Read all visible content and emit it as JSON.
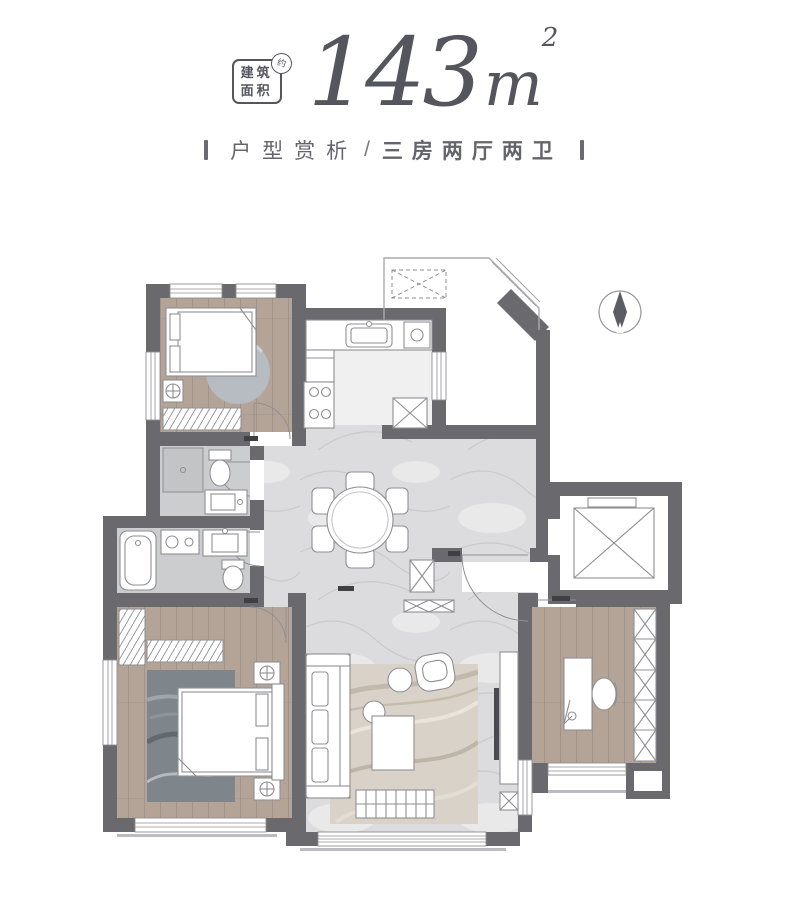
{
  "header": {
    "badge": {
      "line1": "建筑",
      "line2": "面积",
      "stamp": "约"
    },
    "area": {
      "value": "143",
      "unit": "m",
      "exponent": "2"
    },
    "subtitle": {
      "part1": "户型赏析",
      "separator": "/",
      "part2": "三房两厅两卫"
    }
  },
  "plan": {
    "compass_icon": "north-arrow",
    "rooms": [
      "bedroom-secondary",
      "kitchen",
      "terrace",
      "dining-hall",
      "bathroom-guest",
      "bathroom-master",
      "bedroom-master",
      "living-room",
      "study",
      "elevator-shaft",
      "entry",
      "balcony"
    ],
    "colors": {
      "ink": "#55555e",
      "wall": "#6a6a6e",
      "wood": "#b3a497",
      "woodline": "#a2938a",
      "marble": "#dcdcde",
      "vein": "#cacacd",
      "tile": "#cbcdcf",
      "line": "#8f8f93",
      "outline": "#aaaaae",
      "rugdark": "#7e858b",
      "ruglight": "#d8d2c9",
      "handle": "#3f3f44"
    }
  }
}
